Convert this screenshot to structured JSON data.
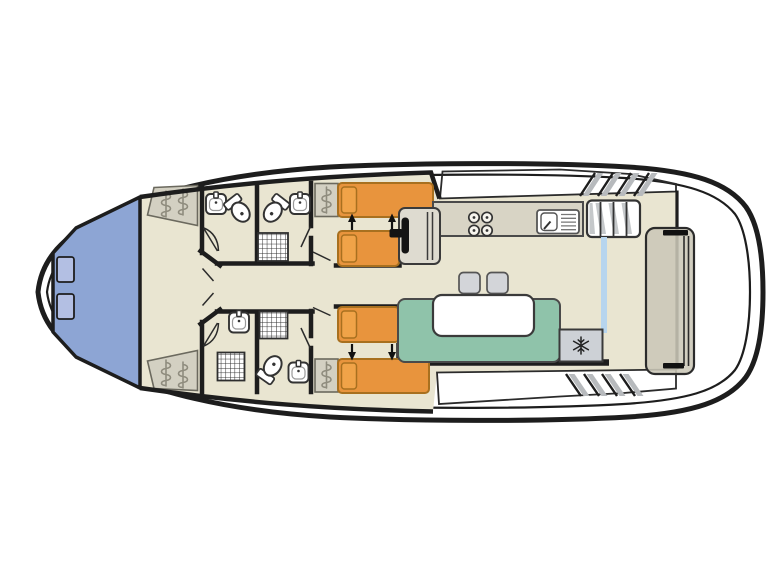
{
  "image": {
    "width": 768,
    "height": 576,
    "background": "#ffffff",
    "description": "Top-down floor plan of a canal cruiser houseboat with bow V-berth cabin, two twin cabins, bathroom compartments, galley, helm seat, saloon with table and fridge, side decks with steps and an aft bench"
  },
  "colors": {
    "wall": "#1d1d1d",
    "floor": "#e9e5d1",
    "berth_blue": "#8da5d4",
    "berth_pillow": "#b3bfe3",
    "bed_orange": "#e8943d",
    "bed_border": "#a8701f",
    "bed_pillow": "#f0a348",
    "sofa_green": "#8fc3aa",
    "counter": "#d8d4c5",
    "unit_grey": "#d3d0c2",
    "squiggle": "#8f8c7e",
    "seat": "#dedbd0",
    "stool": "#d3d5d9",
    "fridge": "#cdd1d6",
    "hatch_grey": "#b7babd",
    "door_blue": "#b7d5ee",
    "bench": "#cbc7b7",
    "deck_white": "#ffffff"
  },
  "plan": {
    "description": "Top-down floor plan of a canal cruiser houseboat: pointed bow at left with blue V-berth bed and two pillows, two mirrored twin-bed cabins with orange single beds and slide-together arrows, four wet-room compartments with sinks, toilets and shower trays, central corridor, helm seat with steering wheel, galley counter with 4-burner hob and sink, stairs to side deck, saloon with U-sofa, white table, two stools and a fridge marked with a snowflake, rounded stern with aft bench",
    "areas": [
      {
        "name": "bow-cabin",
        "detail": "V-berth double bed (blue) with 2 pillows and 2 hanging wardrobes"
      },
      {
        "name": "bathroom-fore-port",
        "detail": "sink and toilet"
      },
      {
        "name": "bathroom-fore-starboard",
        "detail": "sink, toilet and shower tray"
      },
      {
        "name": "bathroom-aft-port",
        "detail": "sink and shower tray"
      },
      {
        "name": "bathroom-aft-starboard",
        "detail": "sink, toilet and shower tray"
      },
      {
        "name": "twin-cabin-port",
        "detail": "2 orange single beds with slide-together arrows and wardrobe"
      },
      {
        "name": "twin-cabin-starboard",
        "detail": "2 orange single beds with slide-together arrows and wardrobe"
      },
      {
        "name": "helm",
        "detail": "helm seat with steering wheel"
      },
      {
        "name": "galley",
        "detail": "counter with 4-burner hob and sink with drainer"
      },
      {
        "name": "saloon",
        "detail": "U-shaped sofa, white table, 2 stools, fridge with snowflake symbol"
      },
      {
        "name": "side-decks",
        "detail": "white walkways with moulded steps"
      },
      {
        "name": "aft-deck",
        "detail": "rounded stern with long bench seat"
      }
    ],
    "fixture_counts": {
      "beds_single": 4,
      "beds_double": 1,
      "sinks": 5,
      "toilets": 3,
      "showers": 3,
      "wardrobes": 4,
      "stools": 2,
      "fridges": 1
    }
  }
}
